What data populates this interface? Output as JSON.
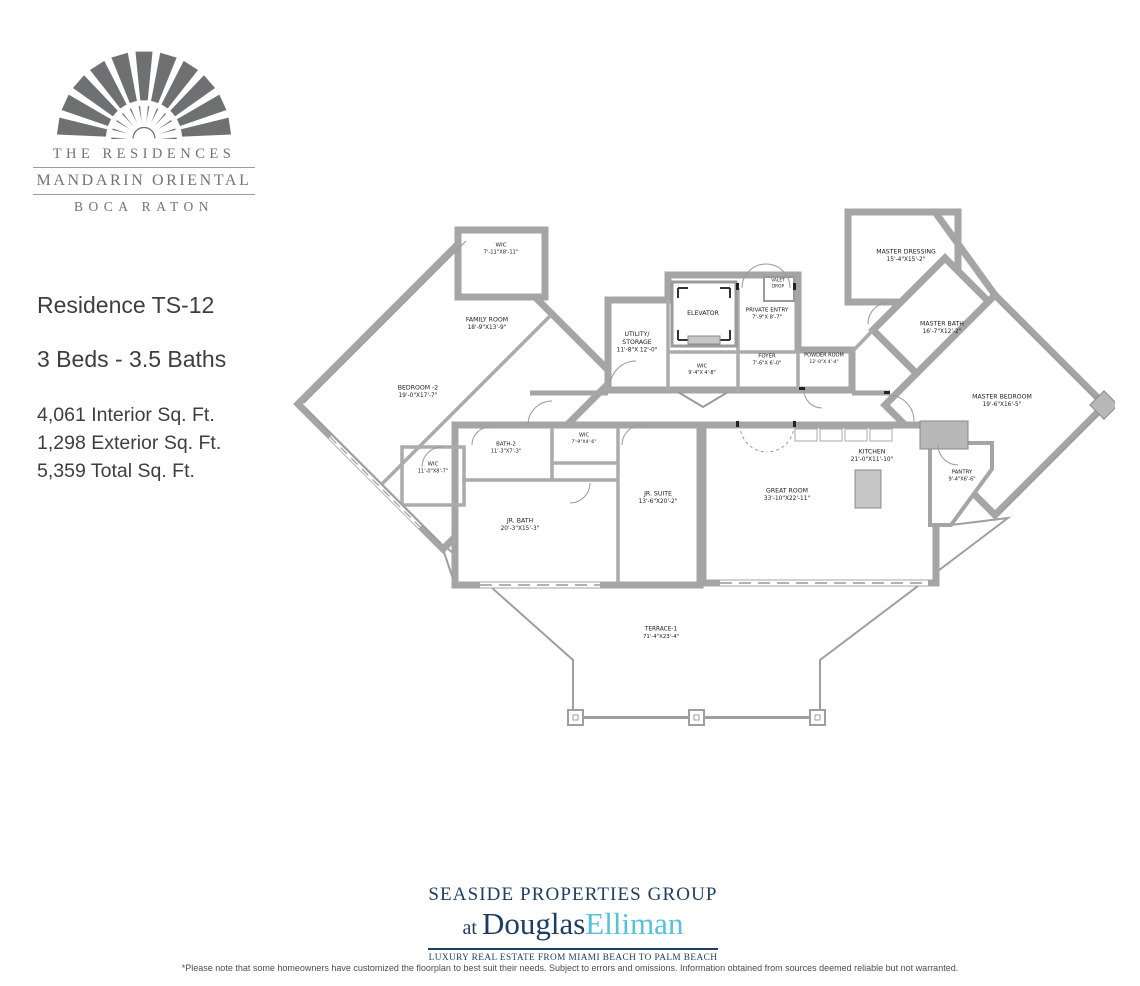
{
  "logo": {
    "line1": "THE RESIDENCES",
    "line2": "MANDARIN ORIENTAL",
    "line3": "BOCA RATON"
  },
  "info": {
    "residence": "Residence TS-12",
    "beds_baths": "3 Beds - 3.5 Baths",
    "interior": "4,061 Interior Sq. Ft.",
    "exterior": "1,298 Exterior Sq. Ft.",
    "total": "5,359 Total Sq. Ft."
  },
  "floorplan": {
    "rooms": [
      {
        "id": "wic_top",
        "name": "WIC",
        "dims": "7'-11\"X8'-11\""
      },
      {
        "id": "family_room",
        "name": "FAMILY ROOM",
        "dims": "18'-9\"X13'-9\""
      },
      {
        "id": "bedroom2",
        "name": "BEDROOM -2",
        "dims": "19'-0\"X17'-7\""
      },
      {
        "id": "utility_storage",
        "name": "UTILITY/\nSTORAGE",
        "dims": "11'-8\"X 12'-0\""
      },
      {
        "id": "elevator",
        "name": "ELEVATOR",
        "dims": ""
      },
      {
        "id": "valet_drop",
        "name": "VALET\nDROP",
        "dims": ""
      },
      {
        "id": "private_entry",
        "name": "PRIVATE ENTRY",
        "dims": "7'-9\"X 8'-7\""
      },
      {
        "id": "foyer",
        "name": "FOYER",
        "dims": "7'-6\"X 6'-0\""
      },
      {
        "id": "wic_center",
        "name": "WIC",
        "dims": "9'-4\"X 4'-8\""
      },
      {
        "id": "powder_room",
        "name": "POWDER ROOM",
        "dims": "12'-0\"X 4'-4\""
      },
      {
        "id": "master_dressing",
        "name": "MASTER DRESSING",
        "dims": "15'-4\"X15'-2\""
      },
      {
        "id": "master_bath",
        "name": "MASTER BATH",
        "dims": "16'-7\"X12'-2\""
      },
      {
        "id": "master_bedroom",
        "name": "MASTER BEDROOM",
        "dims": "19'-6\"X16'-5\""
      },
      {
        "id": "pantry",
        "name": "PANTRY",
        "dims": "9'-4\"X6'-6\""
      },
      {
        "id": "wic_left",
        "name": "WIC",
        "dims": "11'-0\"X8'-7\""
      },
      {
        "id": "bath2",
        "name": "BATH-2",
        "dims": "11'-3\"X7'-3\""
      },
      {
        "id": "wic_jr",
        "name": "WIC",
        "dims": "7'-9\"X4'-6\""
      },
      {
        "id": "jr_suite",
        "name": "JR. SUITE",
        "dims": "13'-6\"X20'-2\""
      },
      {
        "id": "jr_bath",
        "name": "JR. BATH",
        "dims": "20'-3\"X15'-3\""
      },
      {
        "id": "great_room",
        "name": "GREAT ROOM",
        "dims": "33'-10\"X22'-11\""
      },
      {
        "id": "kitchen",
        "name": "KITCHEN",
        "dims": "21'-0\"X11'-10\""
      },
      {
        "id": "terrace",
        "name": "TERRACE-1",
        "dims": "71'-4\"X23'-4\""
      }
    ]
  },
  "footer": {
    "group": "SEASIDE PROPERTIES GROUP",
    "at_label": "at ",
    "brand_dark": "Douglas",
    "brand_light": "Elliman",
    "tagline": "LUXURY REAL ESTATE FROM MIAMI BEACH TO PALM BEACH",
    "disclaimer": "*Please note that some homeowners have customized the floorplan to best suit their needs. Subject to errors and omissions. Information obtained from sources deemed reliable but not warranted."
  },
  "colors": {
    "wall_gray": "#a5a5a5",
    "logo_gray": "#6e7072",
    "navy": "#1e3e61",
    "light_blue": "#55c1dd"
  }
}
